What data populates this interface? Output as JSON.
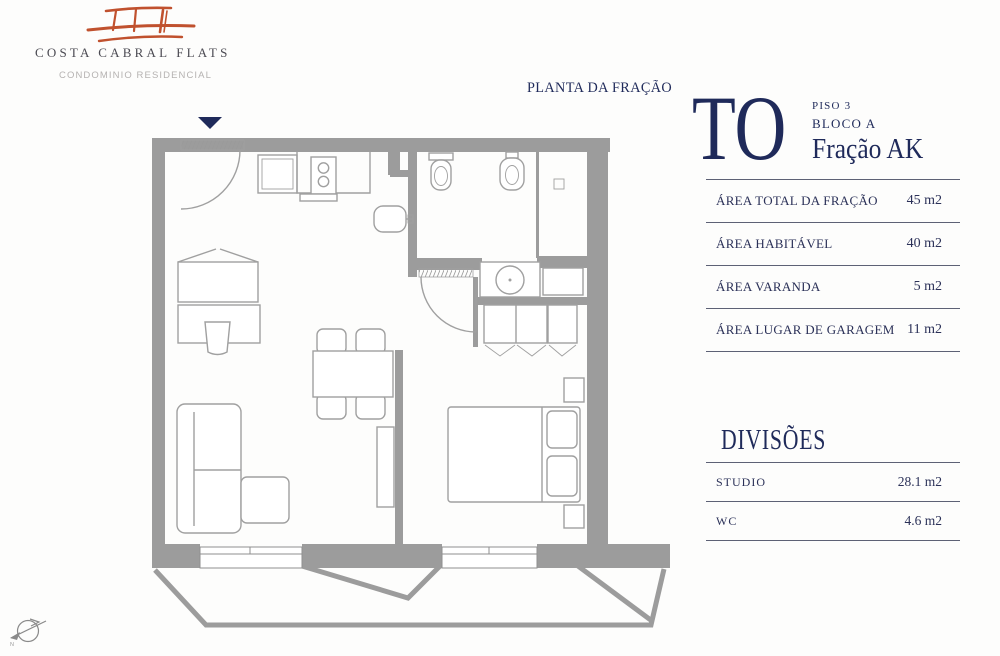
{
  "brand": {
    "name": "COSTA CABRAL FLATS",
    "subtitle": "CONDOMINIO RESIDENCIAL"
  },
  "plan": {
    "title": "PLANTA DA FRAÇÃO"
  },
  "unit": {
    "code": "TO",
    "floor": "PISO 3",
    "block": "BLOCO A",
    "fraction": "Fração AK"
  },
  "areas": {
    "rows": [
      {
        "label": "ÁREA TOTAL DA FRAÇÃO",
        "value": "45 m2"
      },
      {
        "label": "ÁREA HABITÁVEL",
        "value": "40 m2"
      },
      {
        "label": "ÁREA VARANDA",
        "value": "5 m2"
      },
      {
        "label": "ÁREA LUGAR DE GARAGEM",
        "value": "11 m2"
      }
    ]
  },
  "divisions": {
    "title": "DIVISÕES",
    "rows": [
      {
        "label": "STUDIO",
        "value": "28.1 m2"
      },
      {
        "label": "WC",
        "value": "4.6 m2"
      }
    ]
  },
  "compass": {
    "label": "N"
  },
  "colors": {
    "navy": "#1f2a5a",
    "logo_red": "#c0512e",
    "wall": "#9c9c9c",
    "furn": "#a0a0a0",
    "rule": "#5d6175",
    "muted": "#b5b2b1"
  }
}
